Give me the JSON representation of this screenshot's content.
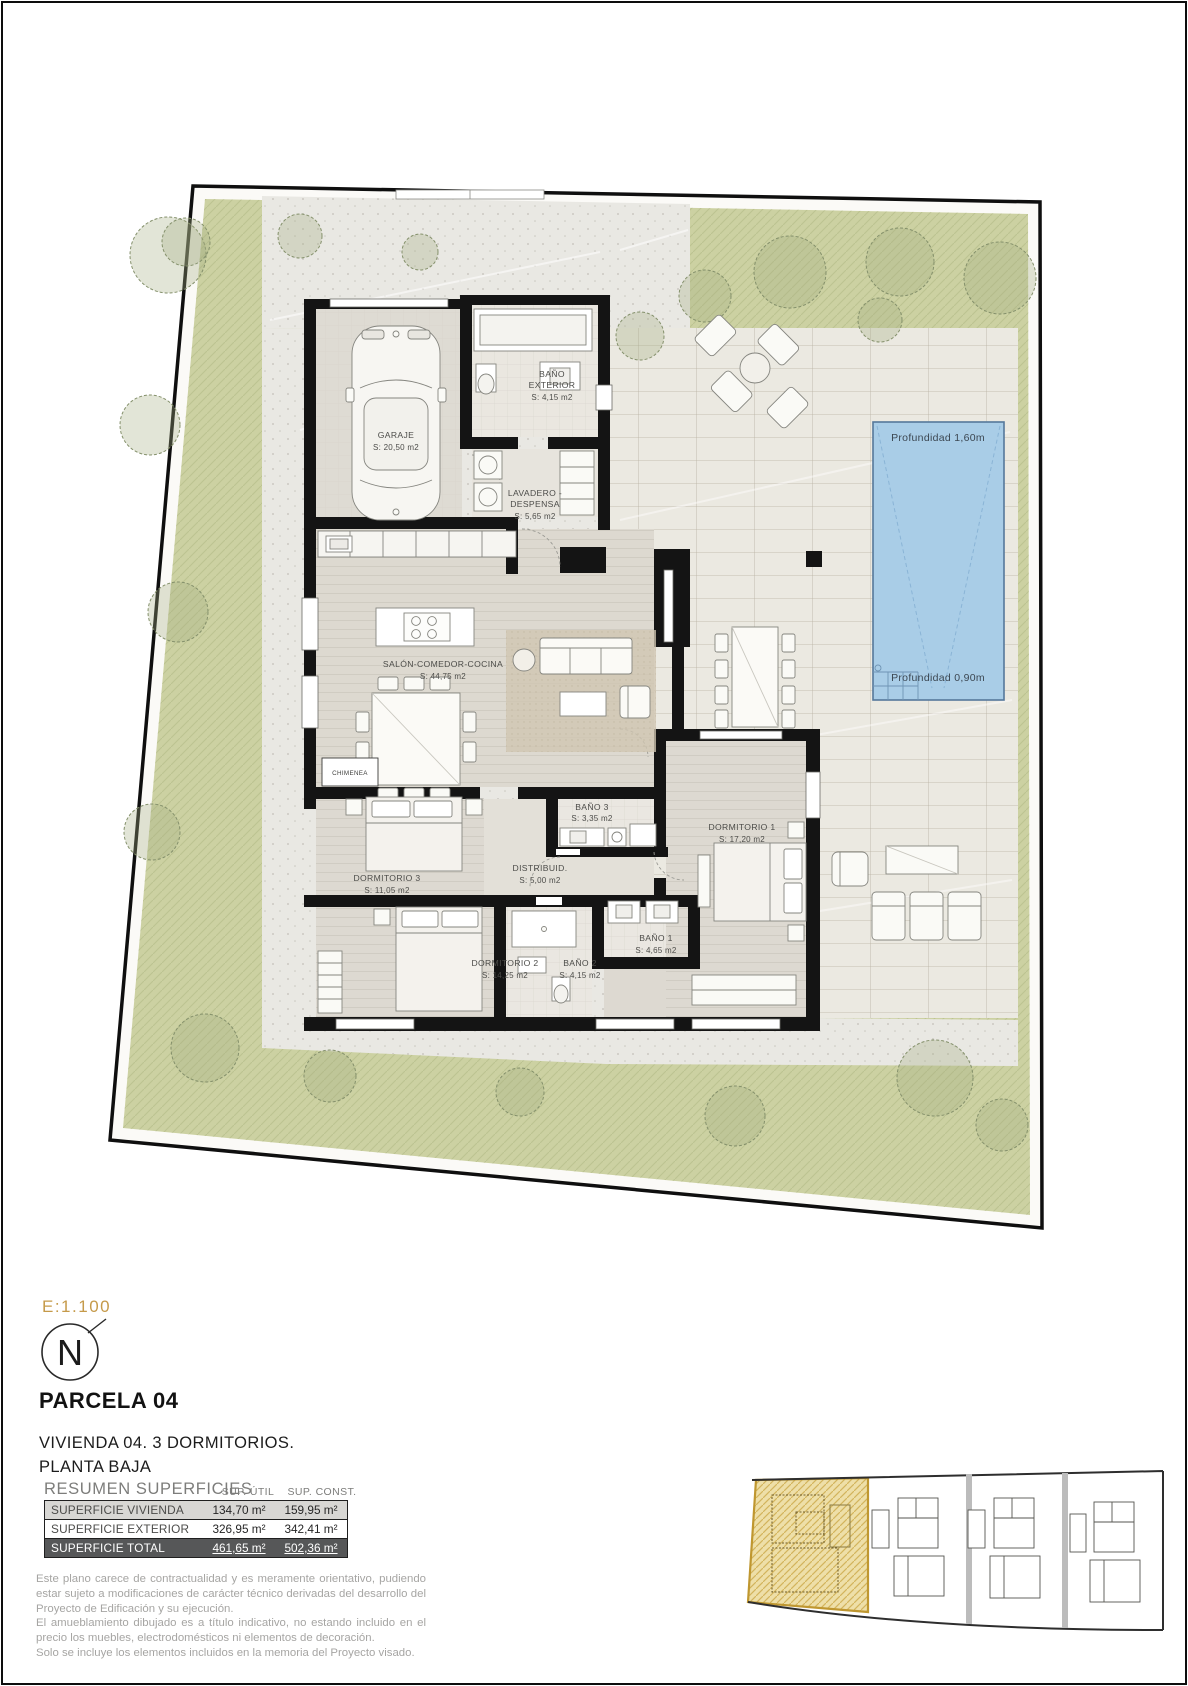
{
  "plan": {
    "pool": {
      "depth_top": "Profundidad 1,60m",
      "depth_bottom": "Profundidad 0,90m"
    },
    "rooms": {
      "garaje": {
        "name": "GARAJE",
        "area": "S: 20,50 m2"
      },
      "bano_exterior": {
        "name1": "BAÑO",
        "name2": "EXTERIOR",
        "area": "S: 4,15 m2"
      },
      "lavadero": {
        "name1": "LAVADERO -",
        "name2": "DESPENSA",
        "area": "S: 5,65 m2"
      },
      "salon": {
        "name": "SALÓN-COMEDOR-COCINA",
        "area": "S: 44,75 m2"
      },
      "chimenea": {
        "name": "CHIMENEA"
      },
      "dormitorio1": {
        "name": "DORMITORIO 1",
        "area": "S: 17,20 m2"
      },
      "dormitorio2": {
        "name": "DORMITORIO 2",
        "area": "S: 14,25 m2"
      },
      "dormitorio3": {
        "name": "DORMITORIO 3",
        "area": "S: 11,05 m2"
      },
      "distribuidor": {
        "name": "DISTRIBUID.",
        "area": "S: 5,00 m2"
      },
      "bano1": {
        "name": "BAÑO 1",
        "area": "S: 4,65 m2"
      },
      "bano2": {
        "name": "BAÑO 2",
        "area": "S: 4,15 m2"
      },
      "bano3": {
        "name": "BAÑO 3",
        "area": "S: 3,35 m2"
      }
    }
  },
  "legend": {
    "scale": "E:1.100",
    "north": "N",
    "parcela": "PARCELA 04",
    "vivienda_line1": "VIVIENDA 04. 3 DORMITORIOS.",
    "vivienda_line2": "PLANTA BAJA"
  },
  "summary": {
    "title": "RESUMEN SUPERFICIES",
    "col_util": "SUP. ÚTIL",
    "col_const": "SUP. CONST.",
    "rows": [
      {
        "label": "SUPERFICIE VIVIENDA",
        "util": "134,70 m²",
        "const": "159,95 m²"
      },
      {
        "label": "SUPERFICIE EXTERIOR",
        "util": "326,95 m²",
        "const": "342,41 m²"
      },
      {
        "label": "SUPERFICIE TOTAL",
        "util": "461,65 m²",
        "const": "502,36 m²"
      }
    ]
  },
  "disclaimer": {
    "para1": "Este plano carece de contractualidad y es meramente orientativo, pudiendo estar sujeto a modificaciones de carácter técnico derivadas del desarrollo del Proyecto de Edificación y su ejecución.",
    "para2": "El amueblamiento dibujado es a título indicativo, no estando incluido en el precio los muebles, electrodomésticos ni elementos de decoración.",
    "para3": "Solo se incluye los elementos incluidos en la memoria del Proyecto visado."
  },
  "colors": {
    "accent_gold": "#c59a4a",
    "garden_green": "#ccd1a2",
    "pool_blue": "#a9cde7",
    "wall_black": "#141414"
  }
}
